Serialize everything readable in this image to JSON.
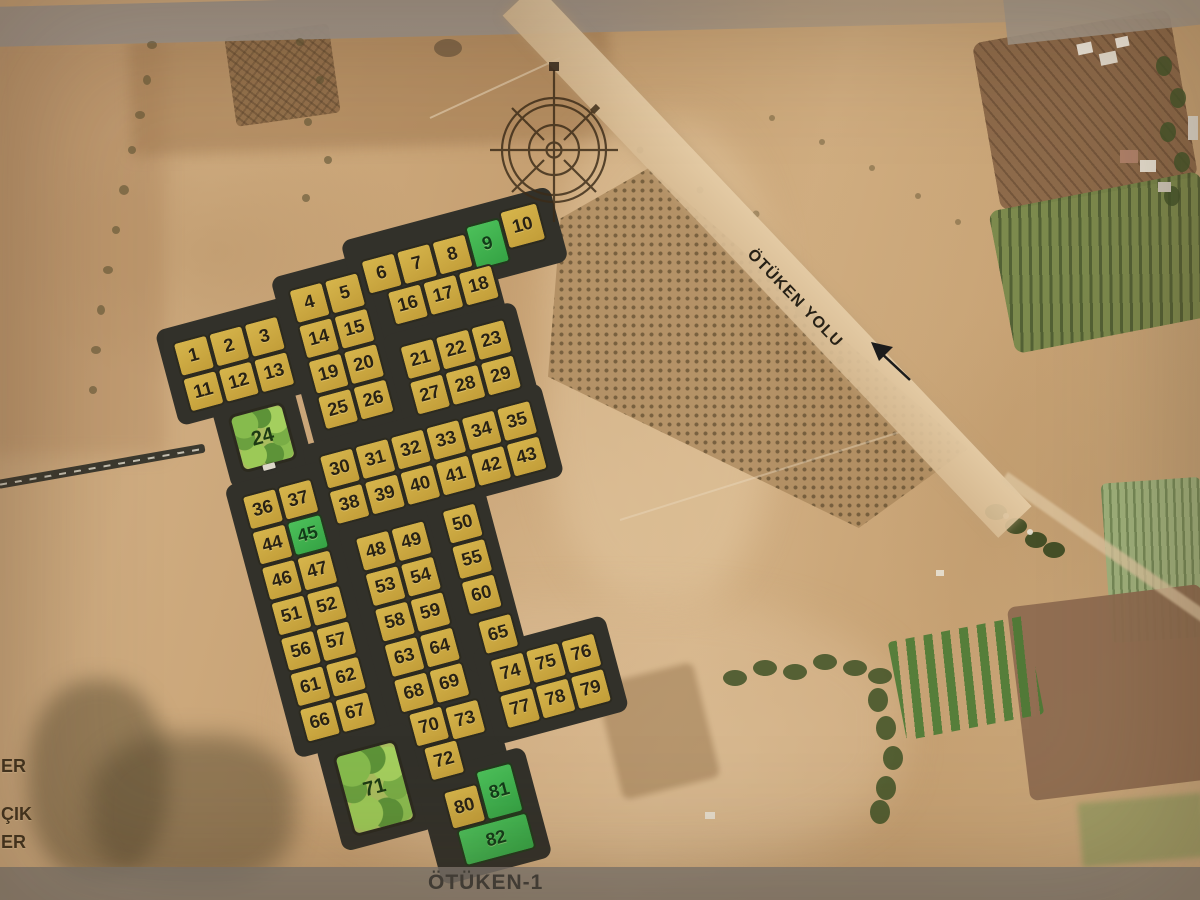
{
  "scene": {
    "type": "satellite-parcel-plan",
    "bottom_bar_label": "ÖTÜKEN-1",
    "road_label": "ÖTÜKEN YOLU",
    "legend_fragments": [
      "ER",
      "ÇIK",
      "ER"
    ],
    "compass_icon": "compass-rose-north",
    "colors": {
      "parcel_yellow": "#c9a63f",
      "parcel_green": "#3cb14b",
      "road_dark": "#32312a",
      "park_green": "#a9bd5e",
      "field_tan": "#cda97c",
      "bottom_bar_gray": "#7f7b73"
    },
    "parcels": {
      "green_numbers": [
        "9",
        "45",
        "81",
        "82"
      ],
      "park_numbers": [
        "24",
        "71"
      ],
      "blocks": {
        "A": [
          [
            "1",
            "2",
            "3"
          ],
          [
            "11",
            "12",
            "13"
          ]
        ],
        "B": [
          [
            "4",
            "5"
          ],
          [
            "14",
            "15"
          ],
          [
            "19",
            "20"
          ],
          [
            "25",
            "26"
          ]
        ],
        "C_top": [
          "6",
          "7",
          "8",
          "9",
          "10"
        ],
        "C_bottom": [
          "16",
          "17",
          "18"
        ],
        "D": [
          [
            "21",
            "22",
            "23"
          ],
          [
            "27",
            "28",
            "29"
          ]
        ],
        "F": [
          [
            "30",
            "31",
            "32",
            "33",
            "34",
            "35"
          ],
          [
            "38",
            "39",
            "40",
            "41",
            "42",
            "43"
          ]
        ],
        "G": [
          [
            "36",
            "37"
          ],
          [
            "44",
            "45"
          ],
          [
            "46",
            "47"
          ],
          [
            "51",
            "52"
          ],
          [
            "56",
            "57"
          ],
          [
            "61",
            "62"
          ],
          [
            "66",
            "67"
          ]
        ],
        "H": [
          [
            "48",
            "49"
          ],
          [
            "53",
            "54"
          ],
          [
            "58",
            "59"
          ],
          [
            "63",
            "64"
          ],
          [
            "68",
            "69"
          ]
        ],
        "H_tail": [
          "70",
          "73",
          "72"
        ],
        "I": [
          "50",
          "55",
          "60",
          "65"
        ],
        "J": [
          [
            "74",
            "75",
            "76"
          ],
          [
            "77",
            "78",
            "79"
          ]
        ],
        "L": [
          "80",
          "81",
          "82"
        ]
      }
    }
  }
}
